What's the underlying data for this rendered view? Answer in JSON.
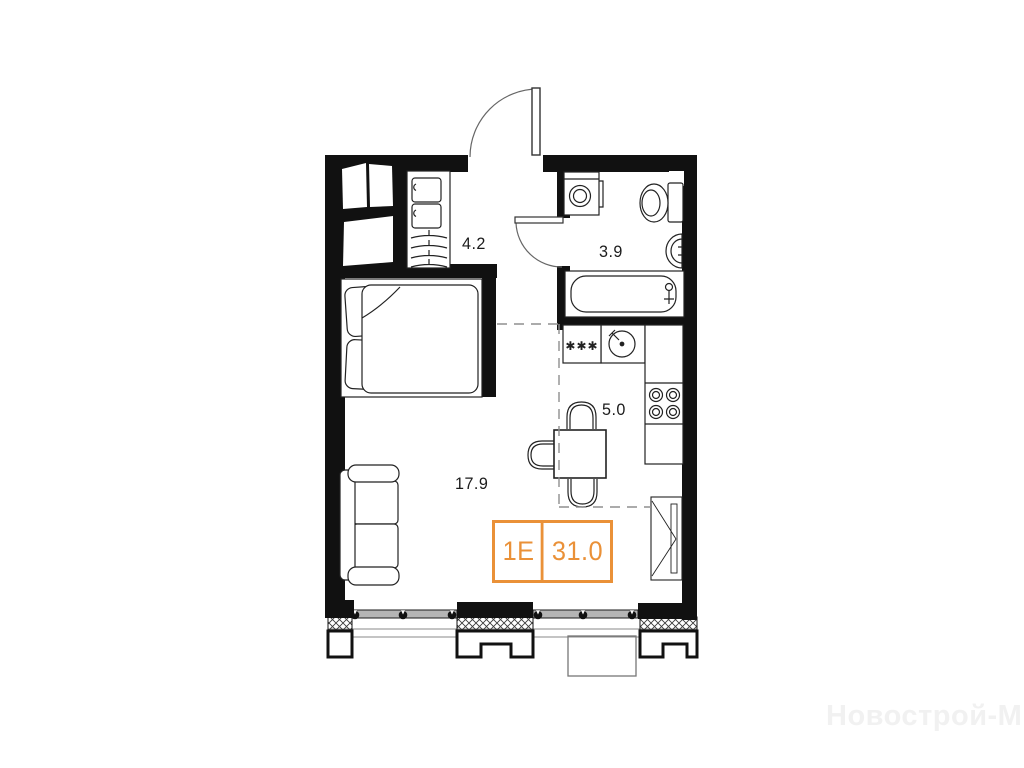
{
  "plan": {
    "badge": {
      "unit": "1E",
      "area": "31.0"
    },
    "rooms": [
      {
        "name": "hallway",
        "area": "4.2"
      },
      {
        "name": "bathroom",
        "area": "3.9"
      },
      {
        "name": "kitchen",
        "area": "5.0"
      },
      {
        "name": "living-room",
        "area": "17.9"
      }
    ],
    "symbols": {
      "freezer": "✱✱✱"
    },
    "watermark": "Новострой-М",
    "colors": {
      "accent": "#EA9138",
      "wall": "#111111",
      "furniture_line": "#222222",
      "glazing": "#b5b5b5",
      "dashed_zone": "#8f8f8f",
      "watermark": "#f1f1f1"
    }
  }
}
